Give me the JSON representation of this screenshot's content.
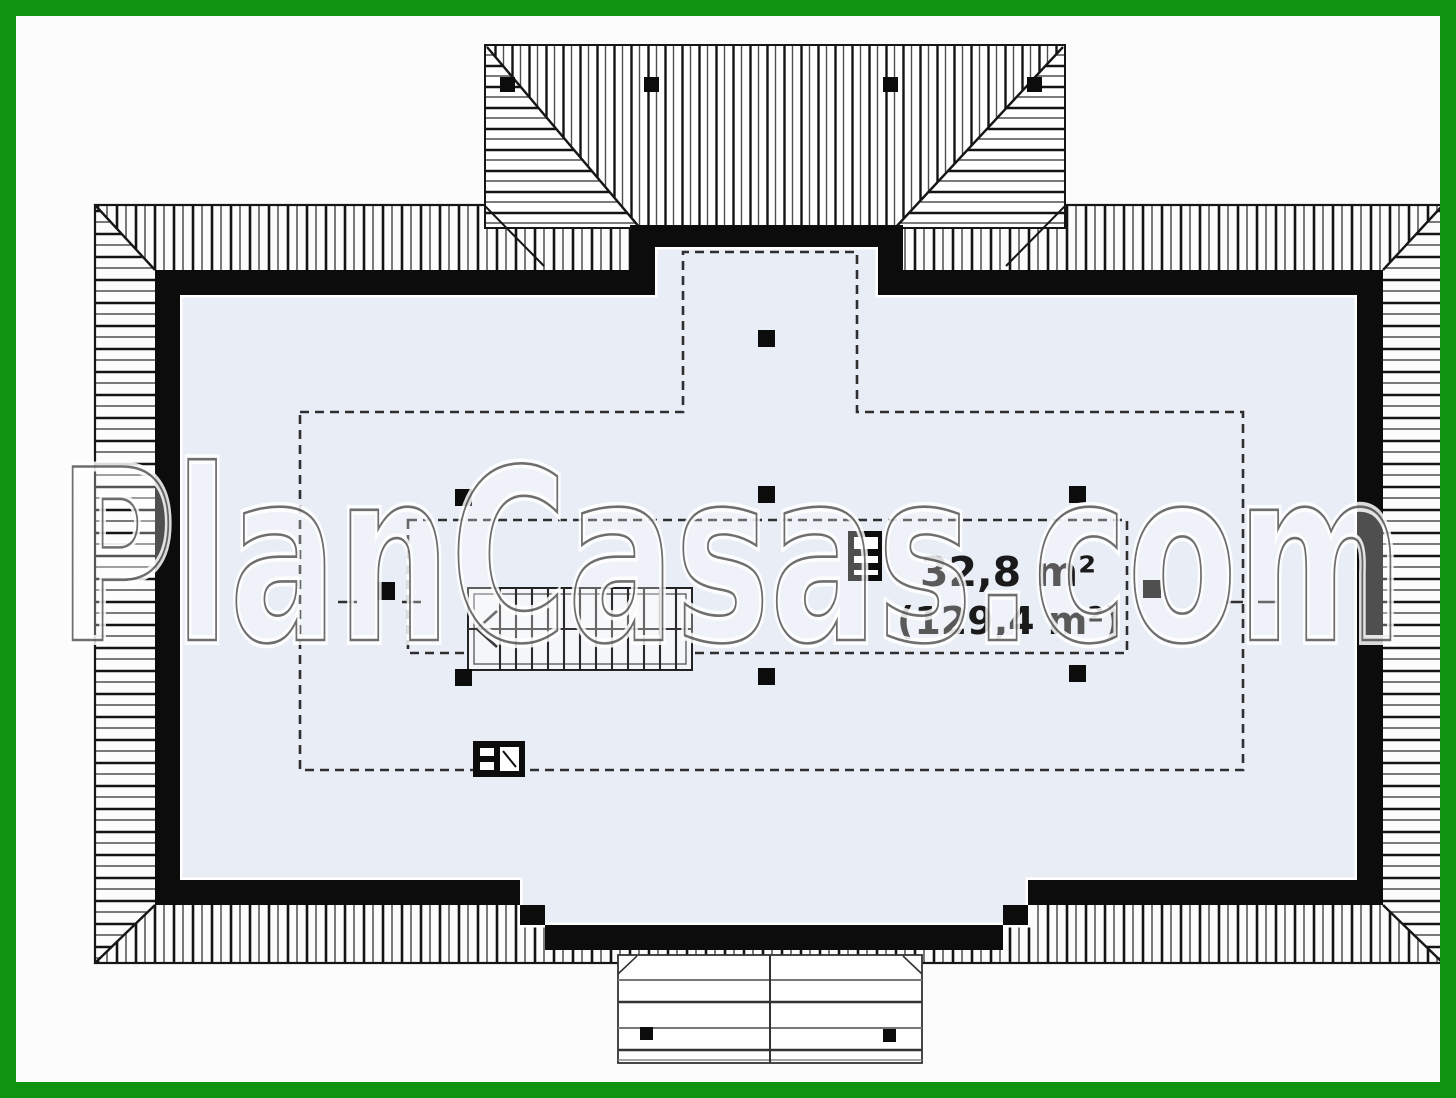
{
  "watermark": {
    "text": "PlanCasas.com"
  },
  "labels": {
    "area_primary": "32,8 m²",
    "area_secondary": "(129,4 m²)"
  },
  "colors": {
    "frame_green": "#0f940f",
    "background": "#fcfcfc",
    "interior_fill": "#e9edf6",
    "wall_black": "#0c0c0c",
    "line_dark": "#161616",
    "hatch_gray": "#4f4f4f",
    "dash_gray": "#2f2f2f",
    "text_black": "#1a1a1a"
  },
  "plan": {
    "kind": "attic-floor-plan",
    "features": [
      "hipped-roof-eaves-hatching",
      "roof-dormer-top",
      "attic-room",
      "height-boundary-dashed-lines",
      "staircase-with-direction-arrow",
      "chimney-flue-symbol",
      "appliance-symbol",
      "structural-post-markers",
      "terrace-deck-bottom"
    ],
    "post_markers": {
      "roof_dormer": 4,
      "interior": 9,
      "terrace": 2
    }
  }
}
